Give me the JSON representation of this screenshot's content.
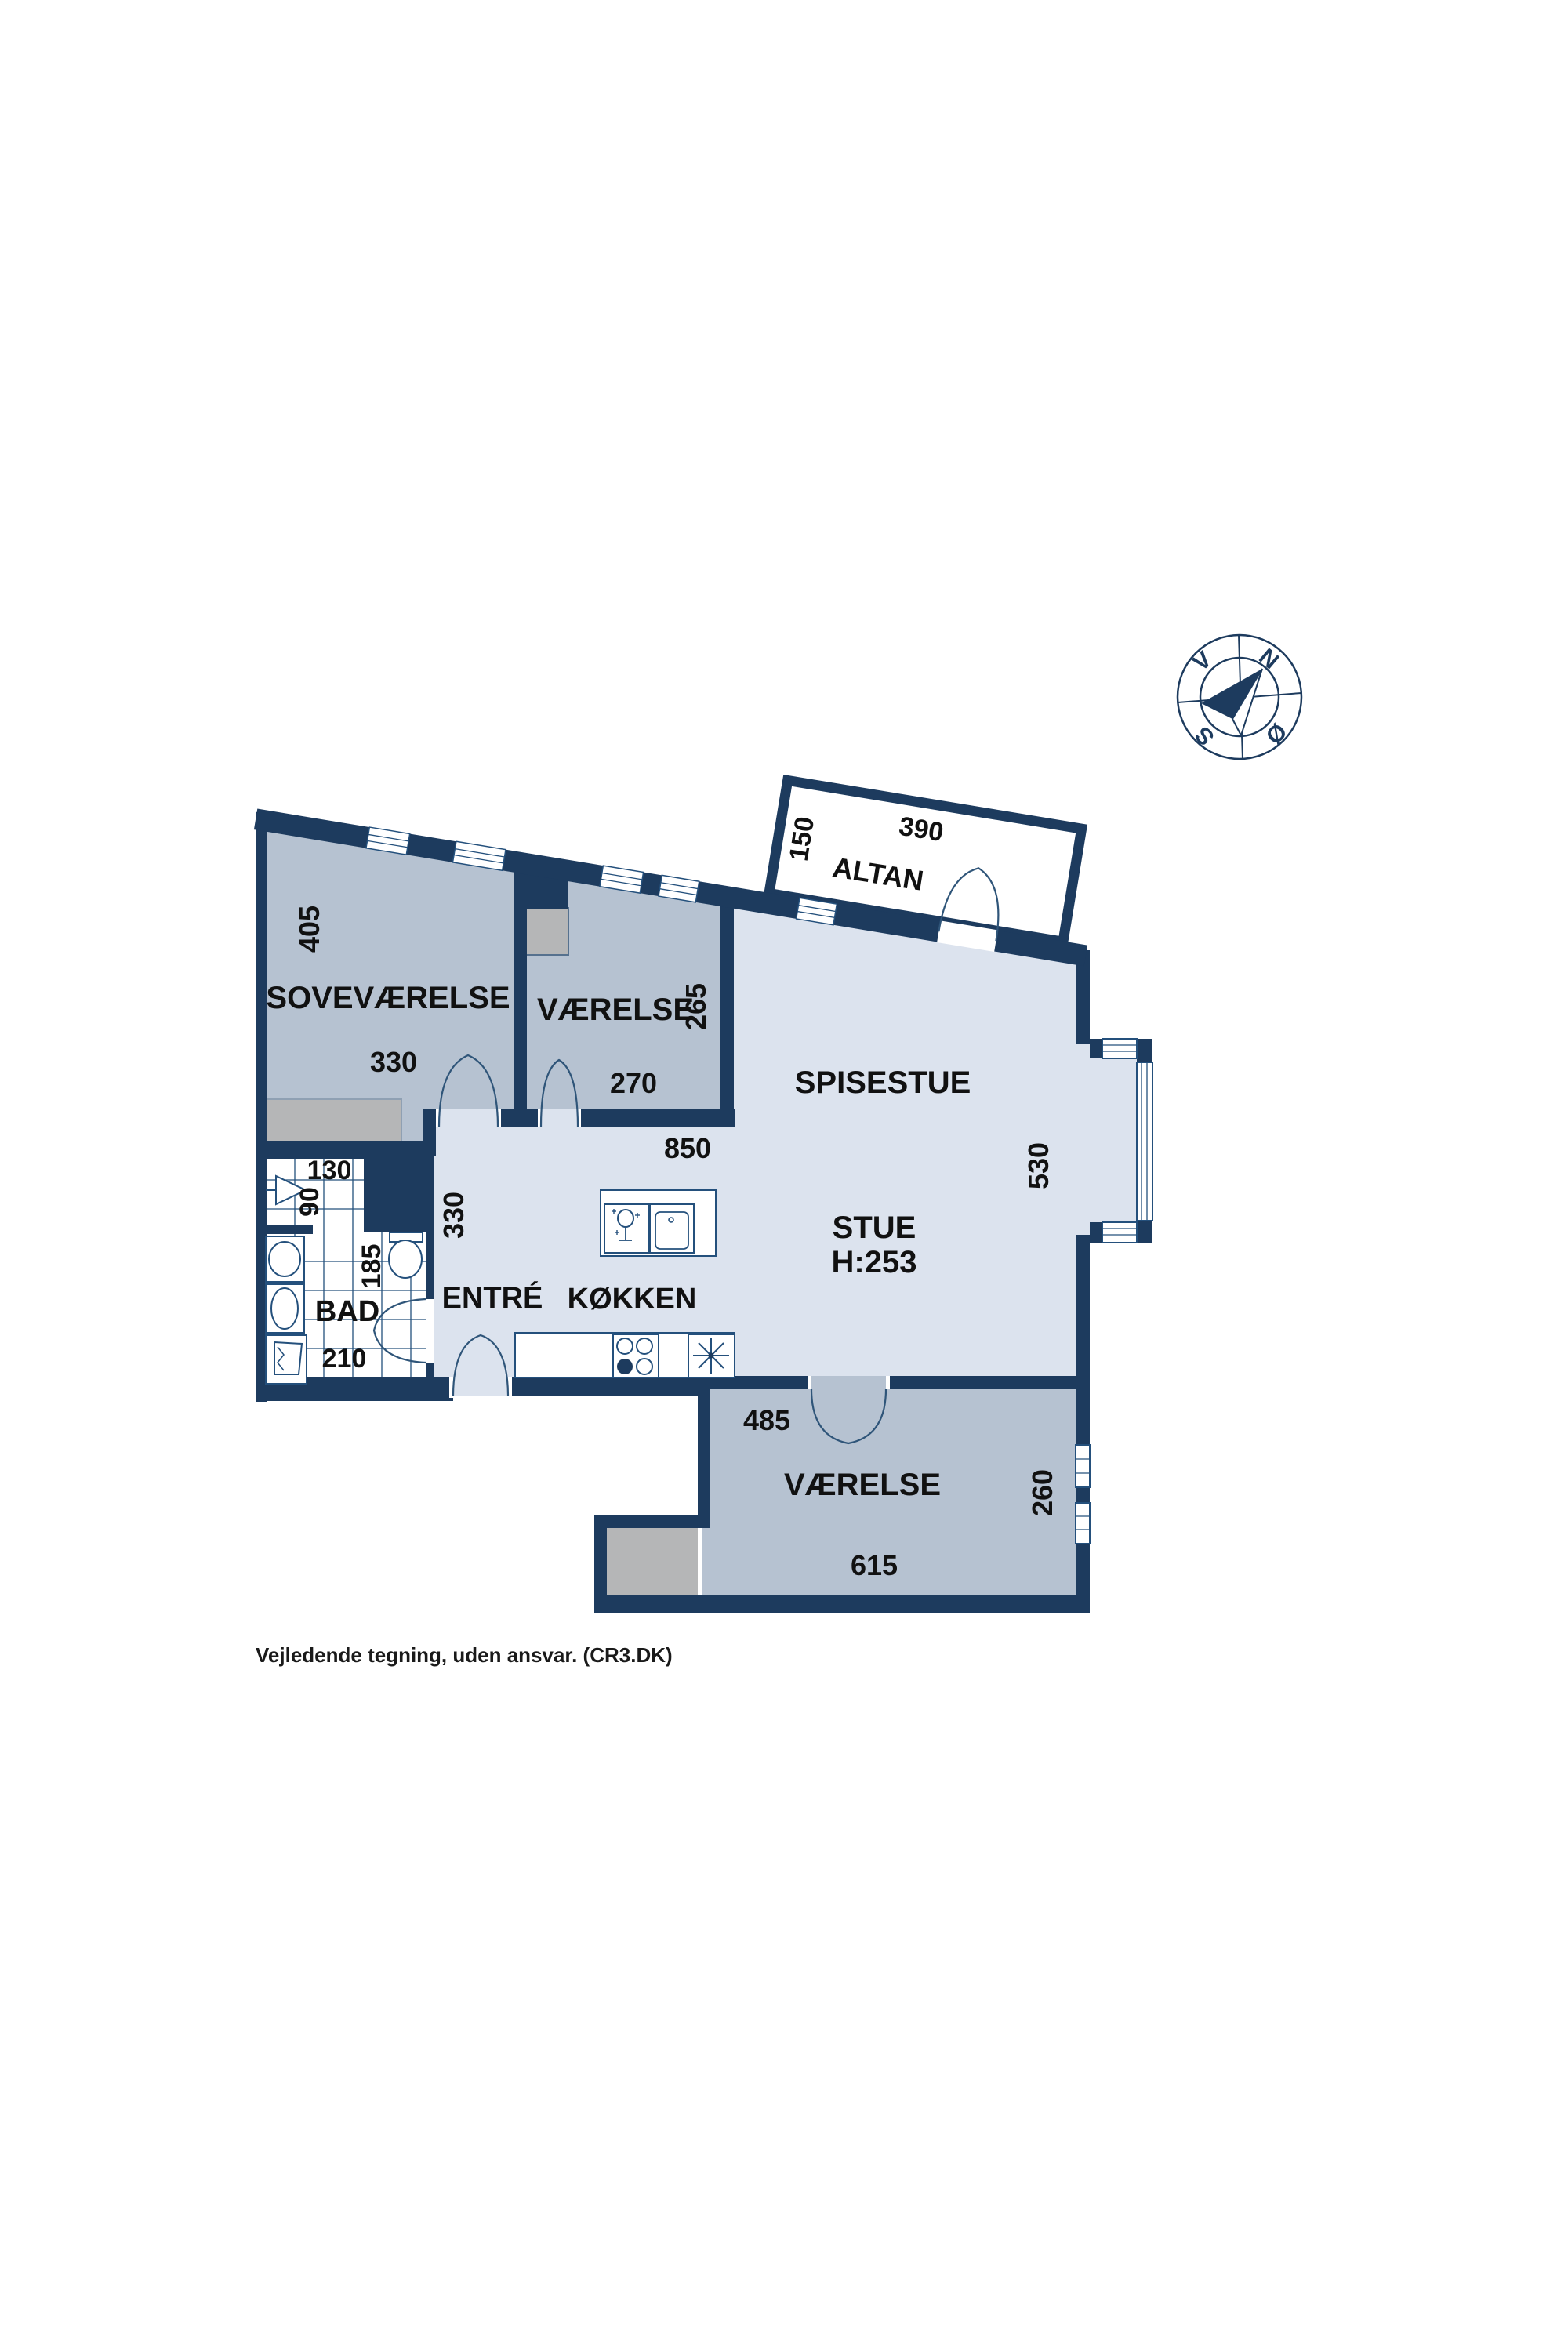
{
  "floorplan": {
    "rooms": {
      "sovevaerelse": {
        "label": "SOVEVÆRELSE",
        "depth": "405",
        "width": "330"
      },
      "vaerelse_top": {
        "label": "VÆRELSE",
        "depth": "265",
        "width": "270"
      },
      "spisestue": {
        "label": "SPISESTUE"
      },
      "stue": {
        "label": "STUE",
        "height_note": "H:253",
        "width": "850",
        "depth": "530"
      },
      "entre": {
        "label": "ENTRÉ",
        "depth": "330"
      },
      "koekken": {
        "label": "KØKKEN"
      },
      "bad": {
        "label": "BAD",
        "niche_width": "130",
        "niche_depth": "90",
        "width": "185",
        "depth": "210"
      },
      "vaerelse_bottom": {
        "label": "VÆRELSE",
        "width_top": "485",
        "width_bottom": "615",
        "depth": "260"
      },
      "altan": {
        "label": "ALTAN",
        "depth": "150",
        "width": "390"
      }
    },
    "compass": {
      "north": "N",
      "east": "Ø",
      "south": "S",
      "west": "V"
    },
    "footer": "Vejledende tegning, uden ansvar. (CR3.DK)",
    "colors": {
      "wall": "#1d3b5e",
      "room_light": "#dce3ee",
      "room_mid": "#b6c2d1",
      "closet_gray": "#b5b6b7",
      "door_arc": "#2f5579",
      "text": "#111111"
    }
  }
}
